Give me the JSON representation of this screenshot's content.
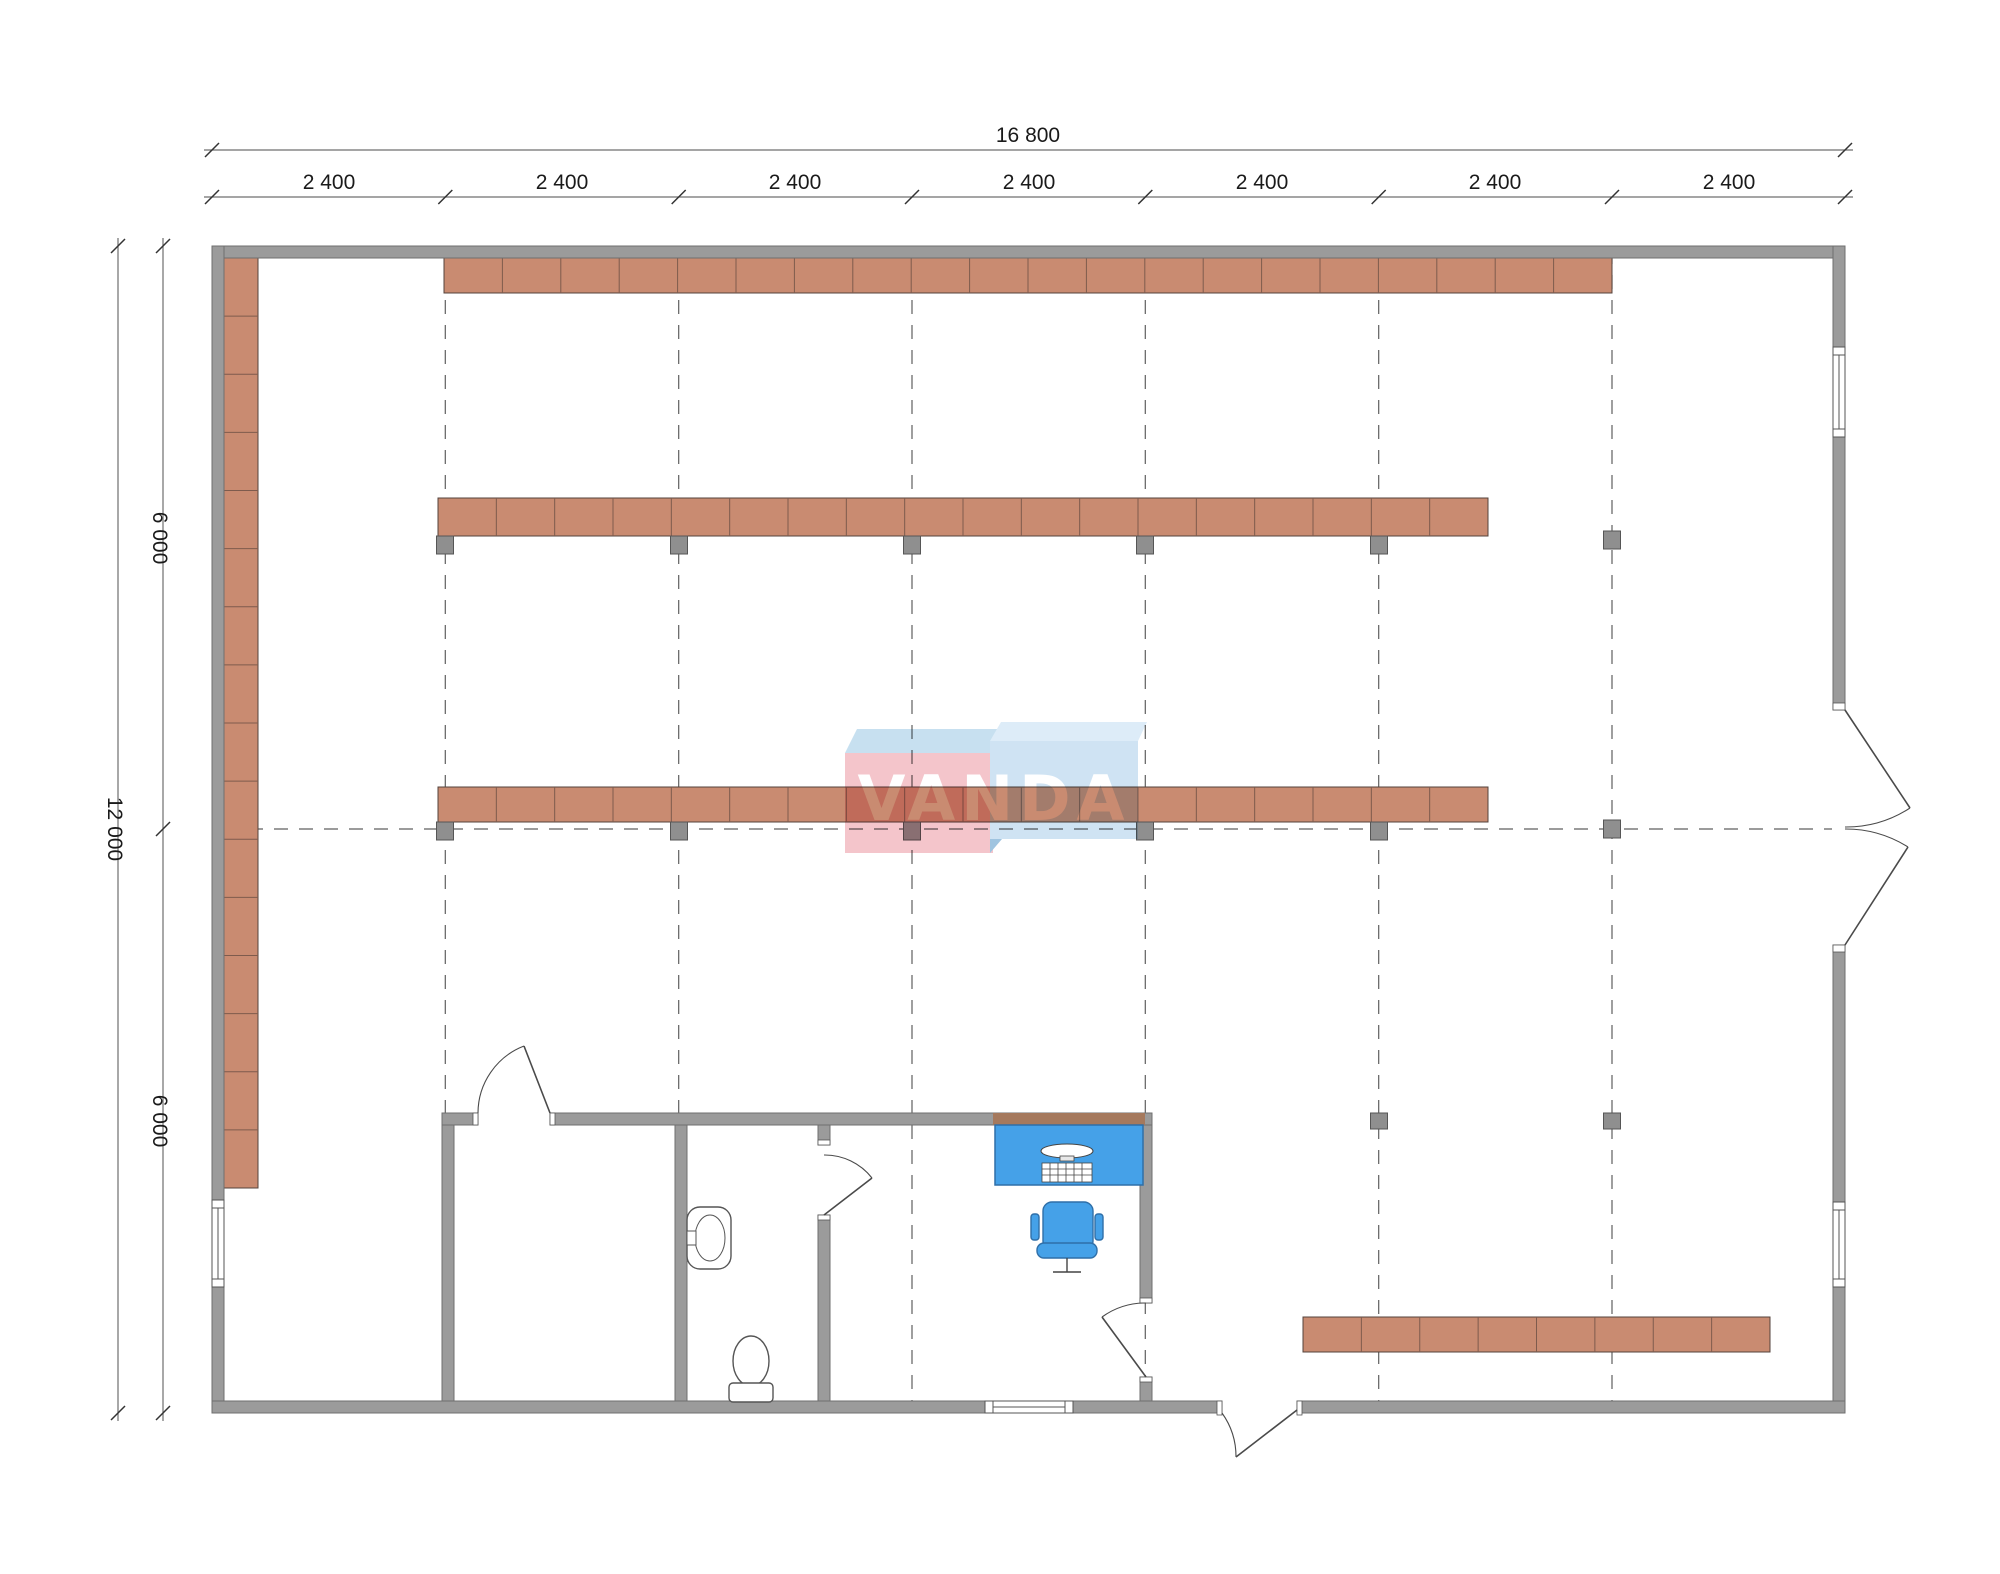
{
  "dimensions": {
    "total_width": "16 800",
    "bays": [
      "2 400",
      "2 400",
      "2 400",
      "2 400",
      "2 400",
      "2 400",
      "2 400"
    ],
    "total_height": "12 000",
    "height_halves": [
      "6 000",
      "6 000"
    ]
  },
  "logo": {
    "text": "VANDA"
  },
  "colors": {
    "wall": "#9b9b9b",
    "wall_outline": "#6f6f6f",
    "shelf": "#c98b71",
    "shelf_outline": "#54433c",
    "shelf_divider": "#7e5b4d",
    "post": "#8f8f8f",
    "post_outline": "#565656",
    "furniture_blue": "#45a1e8",
    "furniture_blue_outline": "#2f6fa8",
    "logo_pink": "#f4c5cb",
    "logo_pink_top": "#c7e0f0",
    "logo_blue": "#cfe3f3",
    "logo_blue_top": "#ddecf8",
    "logo_fold": "#9fc4e0",
    "desk_wall_strip": "#a5795d",
    "line": "#4a4a4a",
    "grid_line": "#5f5f5f",
    "fixture_line": "#555555"
  },
  "grid": {
    "columns_x": [
      445.3,
      678.7,
      912,
      1145.3,
      1378.7,
      1612
    ],
    "top": 250,
    "bottom": 1408,
    "middle_row_y": 829,
    "row_x1": 224,
    "row_x2": 1832
  },
  "shelving": {
    "rows": [
      {
        "name": "shelf-row-top",
        "x": 444,
        "y": 258,
        "w": 1168,
        "h": 35,
        "tiles": 20,
        "dir": "h"
      },
      {
        "name": "shelf-column-left-wall",
        "x": 224,
        "y": 258,
        "w": 34,
        "h": 930,
        "tiles": 16,
        "dir": "v"
      },
      {
        "name": "shelf-row-second",
        "x": 438,
        "y": 498,
        "w": 1050,
        "h": 38,
        "tiles": 18,
        "dir": "h"
      },
      {
        "name": "shelf-row-middle",
        "x": 438,
        "y": 787,
        "w": 1050,
        "h": 35,
        "tiles": 18,
        "dir": "h"
      },
      {
        "name": "shelf-row-bottom-right",
        "x": 1303,
        "y": 1317,
        "w": 467,
        "h": 35,
        "tiles": 8,
        "dir": "h"
      }
    ],
    "posts": [
      {
        "x": 445,
        "y": 536
      },
      {
        "x": 679,
        "y": 536
      },
      {
        "x": 912,
        "y": 536
      },
      {
        "x": 1145,
        "y": 536
      },
      {
        "x": 1379,
        "y": 536
      },
      {
        "x": 1612,
        "y": 531
      },
      {
        "x": 445,
        "y": 822
      },
      {
        "x": 679,
        "y": 822
      },
      {
        "x": 912,
        "y": 822
      },
      {
        "x": 1145,
        "y": 822
      },
      {
        "x": 1379,
        "y": 822
      },
      {
        "x": 1612,
        "y": 820
      },
      {
        "x": 1379,
        "y": 1113,
        "h": 16
      },
      {
        "x": 1612,
        "y": 1113,
        "h": 16
      }
    ]
  }
}
